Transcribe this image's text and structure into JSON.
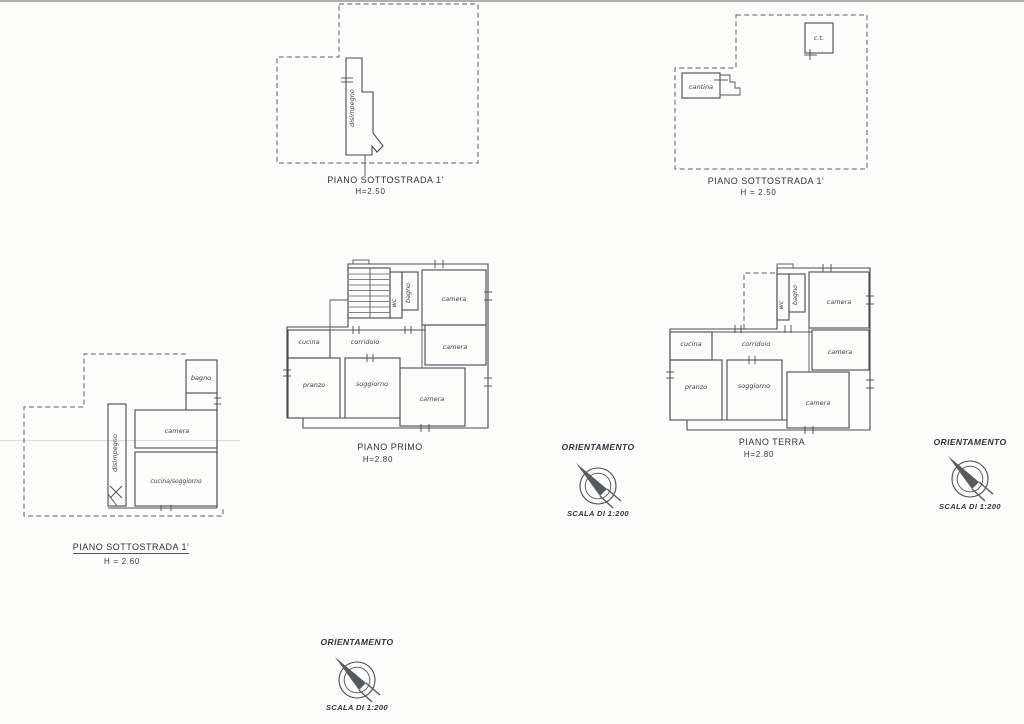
{
  "colors": {
    "ink": "#474c52",
    "paper": "#fcfcfa"
  },
  "orientation": {
    "label": "ORIENTAMENTO",
    "scale_label": "SCALA DI 1:200"
  },
  "plans": {
    "sottostrada_a": {
      "title": "PIANO SOTTOSTRADA 1'",
      "height_label": "H=2.50",
      "rooms": {
        "disimpegno": "disimpegno"
      }
    },
    "sottostrada_b": {
      "title": "PIANO SOTTOSTRADA 1'",
      "height_label": "H = 2.50",
      "rooms": {
        "cantina": "cantina",
        "ct": "c.t."
      }
    },
    "sottostrada_c": {
      "title": "PIANO SOTTOSTRADA 1'",
      "height_label": "H = 2.60",
      "rooms": {
        "bagno": "bagno",
        "camera": "camera",
        "cucina_soggiorno": "cucina/soggiorno",
        "disimpegno": "disimpegno"
      }
    },
    "primo": {
      "title": "PIANO PRIMO",
      "height_label": "H=2.80",
      "rooms": {
        "wc": "wc",
        "bagno": "bagno",
        "camera_top": "camera",
        "camera_mid": "camera",
        "camera_bottom": "camera",
        "cucina": "cucina",
        "corridoio": "corridoio",
        "pranzo": "pranzo",
        "soggiorno": "soggiorno"
      }
    },
    "terra": {
      "title": "PIANO TERRA",
      "height_label": "H=2.80",
      "rooms": {
        "wc": "wc",
        "bagno": "bagno",
        "camera_top": "camera",
        "camera_mid": "camera",
        "camera_bottom": "camera",
        "cucina": "cucina",
        "corridoio": "corridoio",
        "pranzo": "pranzo",
        "soggiorno": "soggiorno"
      }
    }
  }
}
